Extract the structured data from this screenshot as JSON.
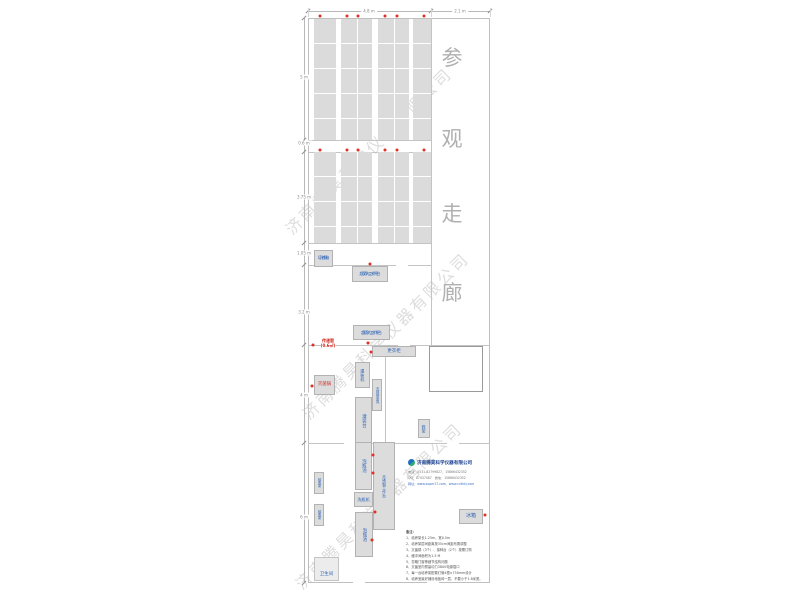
{
  "watermark": {
    "text": "济南腾昊科学仪器有限公司",
    "positions": [
      {
        "x": 368,
        "y": 150
      },
      {
        "x": 385,
        "y": 335
      },
      {
        "x": 378,
        "y": 505
      }
    ]
  },
  "corridor": {
    "label": "参观走廊",
    "chars": [
      {
        "ch": "参",
        "x": 452,
        "y": 57
      },
      {
        "ch": "观",
        "x": 452,
        "y": 138
      },
      {
        "ch": "走",
        "x": 452,
        "y": 213
      },
      {
        "ch": "廊",
        "x": 452,
        "y": 292
      }
    ]
  },
  "dimensions": {
    "top_line": {
      "x1": 308,
      "x2": 490,
      "y": 11
    },
    "top": [
      {
        "label": "4.8 m",
        "cx": 369
      },
      {
        "label": "2.1 m",
        "cx": 460
      }
    ],
    "top_ticks": [
      308,
      431,
      490
    ],
    "left_line": {
      "y1": 18,
      "y2": 583,
      "x": 304
    },
    "left": [
      {
        "label": "5 m",
        "y": 77
      },
      {
        "label": "0.6 m",
        "y": 143
      },
      {
        "label": "3.75 m",
        "y": 197
      },
      {
        "label": "1.05 m",
        "y": 253
      },
      {
        "label": "3.2 m",
        "y": 312
      },
      {
        "label": "4 m",
        "y": 395
      },
      {
        "label": "6 m",
        "y": 517
      }
    ],
    "left_ticks": [
      18,
      140,
      152,
      243,
      265,
      345,
      443,
      583
    ]
  },
  "plan": {
    "outline": {
      "x": 308,
      "y": 18,
      "w": 182,
      "h": 565
    },
    "walls": [
      {
        "x": 308,
        "y": 140,
        "w": 123,
        "h": 1
      },
      {
        "x": 308,
        "y": 152,
        "w": 123,
        "h": 1
      },
      {
        "x": 308,
        "y": 243,
        "w": 123,
        "h": 1
      },
      {
        "x": 308,
        "y": 265,
        "w": 123,
        "h": 1
      },
      {
        "x": 431,
        "y": 18,
        "w": 1,
        "h": 327
      },
      {
        "x": 308,
        "y": 345,
        "w": 182,
        "h": 1
      },
      {
        "x": 385,
        "y": 345,
        "w": 1,
        "h": 98
      },
      {
        "x": 308,
        "y": 443,
        "w": 182,
        "h": 1
      }
    ],
    "door_gaps": [
      {
        "x": 396,
        "y": 264,
        "w": 12,
        "h": 3
      },
      {
        "x": 398,
        "y": 344,
        "w": 12,
        "h": 3
      },
      {
        "x": 344,
        "y": 442,
        "w": 12,
        "h": 3
      },
      {
        "x": 447,
        "y": 442,
        "w": 12,
        "h": 3
      },
      {
        "x": 353,
        "y": 582,
        "w": 12,
        "h": 3
      },
      {
        "x": 427,
        "y": 582,
        "w": 12,
        "h": 3
      }
    ],
    "buffer_room": {
      "x": 429,
      "y": 346,
      "w": 54,
      "h": 46
    },
    "toilet_room": {
      "x": 314,
      "y": 557,
      "w": 25,
      "h": 24
    },
    "rack_sections": [
      {
        "y": 19,
        "h": 121
      },
      {
        "y": 152,
        "h": 91
      }
    ],
    "rack_columns": [
      {
        "x": 314,
        "w": 22,
        "double": false
      },
      {
        "x": 341,
        "w": 31,
        "double": true
      },
      {
        "x": 378,
        "w": 31,
        "double": true
      },
      {
        "x": 413,
        "w": 18,
        "double": false
      }
    ],
    "rooms": [
      {
        "name": "culture-room-1",
        "text": "培养室一",
        "x": 371,
        "y": 146,
        "fs": 6.5
      },
      {
        "name": "culture-room-2",
        "text": "培养室二",
        "x": 371,
        "y": 254,
        "fs": 6.5
      },
      {
        "name": "inoculation-room",
        "text": "接种室",
        "x": 370,
        "y": 306,
        "fs": 6.5
      },
      {
        "name": "changing-room",
        "text": "更衣室",
        "x": 404,
        "y": 396,
        "fs": 6.5
      },
      {
        "name": "sterilizing-room",
        "text": "灭菌室",
        "x": 338,
        "y": 421,
        "fs": 6.5
      },
      {
        "name": "buffer-room",
        "text": "缓冲间",
        "x": 456,
        "y": 370,
        "fs": 5.5
      },
      {
        "name": "bottle-washing-area",
        "text": "洗瓶区",
        "x": 342,
        "y": 504,
        "fs": 6
      },
      {
        "name": "preparation-room",
        "text": "准备室",
        "x": 424,
        "y": 500,
        "fs": 6.5
      },
      {
        "name": "balance-table",
        "text": "天平台",
        "x": 383,
        "y": 540,
        "fs": 5.5
      },
      {
        "name": "pass-window",
        "lines": [
          "传递窗",
          "(0.6㎡)"
        ],
        "x": 328,
        "y": 343,
        "fs": 4
      }
    ],
    "equipment": [
      {
        "name": "light-incubator",
        "lines": [
          "光照",
          "培养箱"
        ],
        "x": 314,
        "y": 250,
        "w": 19,
        "h": 17,
        "dir": "h",
        "color": "blue",
        "fs": 3.8
      },
      {
        "name": "clean-bench-1",
        "lines": [
          "双人水平",
          "超净工作台"
        ],
        "x": 352,
        "y": 266,
        "w": 36,
        "h": 16,
        "dir": "h",
        "color": "blue",
        "fs": 4.2
      },
      {
        "name": "clean-bench-2",
        "lines": [
          "双人水平",
          "超净工作台"
        ],
        "x": 353,
        "y": 325,
        "w": 37,
        "h": 15,
        "dir": "h",
        "color": "blue",
        "fs": 4.2
      },
      {
        "name": "wardrobe",
        "text": "更衣柜",
        "x": 372,
        "y": 346,
        "w": 44,
        "h": 11,
        "dir": "h",
        "color": "blue",
        "fs": 4.5
      },
      {
        "name": "filling-machine",
        "text": "灌装机",
        "x": 355,
        "y": 362,
        "w": 15,
        "h": 26,
        "dir": "v",
        "color": "blue",
        "fs": 4.2
      },
      {
        "name": "sterilizer-pot",
        "text": "灭菌锅",
        "x": 314,
        "y": 375,
        "w": 21,
        "h": 20,
        "dir": "h",
        "color": "red",
        "fs": 4.4
      },
      {
        "name": "steel-bench",
        "text": "不锈钢条凳",
        "x": 372,
        "y": 379,
        "w": 10,
        "h": 32,
        "dir": "v",
        "color": "blue",
        "fs": 3.3
      },
      {
        "name": "filling-table",
        "text": "灌装台",
        "x": 355,
        "y": 397,
        "w": 17,
        "h": 48,
        "dir": "v",
        "color": "blue",
        "fs": 4.5
      },
      {
        "name": "shoe-rack",
        "text": "鞋架",
        "x": 418,
        "y": 419,
        "w": 12,
        "h": 19,
        "dir": "v",
        "color": "blue",
        "fs": 4
      },
      {
        "name": "soaking-pool-1",
        "text": "泡瓶池",
        "x": 355,
        "y": 442,
        "w": 17,
        "h": 48,
        "dir": "v",
        "color": "blue",
        "fs": 4.5
      },
      {
        "name": "steel-worktable",
        "text": "不锈钢工作台",
        "x": 373,
        "y": 442,
        "w": 22,
        "h": 88,
        "dir": "v",
        "color": "blue",
        "fs": 3.8
      },
      {
        "name": "bottle-washer",
        "text": "洗瓶机",
        "x": 354,
        "y": 492,
        "w": 19,
        "h": 15,
        "dir": "h",
        "color": "blue",
        "fs": 4.2
      },
      {
        "name": "soaking-pool-2",
        "text": "泡瓶池",
        "x": 355,
        "y": 512,
        "w": 18,
        "h": 45,
        "dir": "v",
        "color": "blue",
        "fs": 4.5
      },
      {
        "name": "bottle-rack-1",
        "text": "晾瓶架",
        "x": 314,
        "y": 472,
        "w": 10,
        "h": 22,
        "dir": "v",
        "color": "blue",
        "fs": 3.2
      },
      {
        "name": "bottle-rack-2",
        "text": "晾瓶架",
        "x": 314,
        "y": 504,
        "w": 10,
        "h": 22,
        "dir": "v",
        "color": "blue",
        "fs": 3.2
      },
      {
        "name": "fridge",
        "text": "冰箱",
        "x": 459,
        "y": 509,
        "w": 24,
        "h": 15,
        "dir": "h",
        "color": "blue",
        "fs": 5
      },
      {
        "name": "toilet",
        "text": "卫生间",
        "x": 314,
        "y": 568,
        "w": 25,
        "h": 13,
        "dir": "h",
        "color": "blue",
        "fs": 4.5,
        "noborder": true
      }
    ],
    "power_dots": [
      [
        320,
        16
      ],
      [
        347,
        16
      ],
      [
        358,
        16
      ],
      [
        385,
        16
      ],
      [
        397,
        16
      ],
      [
        424,
        16
      ],
      [
        320,
        150
      ],
      [
        347,
        150
      ],
      [
        358,
        150
      ],
      [
        385,
        150
      ],
      [
        397,
        150
      ],
      [
        424,
        150
      ],
      [
        370,
        264
      ],
      [
        368,
        343
      ],
      [
        313,
        345
      ],
      [
        312,
        386
      ],
      [
        371,
        352
      ],
      [
        373,
        455
      ],
      [
        373,
        473
      ],
      [
        375,
        512
      ],
      [
        372,
        540
      ],
      [
        485,
        515
      ]
    ],
    "colors": {
      "room_label": "#cc2a20",
      "equip_label": "#2f64b5",
      "dot": "#e03127"
    }
  },
  "company": {
    "name": "济南腾昊科学仪器有限公司",
    "contacts": [
      "电话：0531-82799827、15866432352",
      "QQ：87437487　微信：15866432352",
      "网址：www.super17.com、www.cnthkj.com"
    ]
  },
  "notes": {
    "title": "备注：",
    "items": [
      "1、培养架长1.25m，宽0.5m",
      "2、培养架层间距离按35cm间距布置调整",
      "3、灭菌锅（3个）、接种台（2个）按需订购",
      "4、缓冲间面积为1.5 M",
      "5、忽略门窗等细节结构问题",
      "6、灭菌室内预留动力380V电源插口",
      "7、每一台培养架配置灯管4根×750mm设计",
      "8、培养室最好铺设地板砖一层，不要小于1.8米宽。"
    ]
  }
}
